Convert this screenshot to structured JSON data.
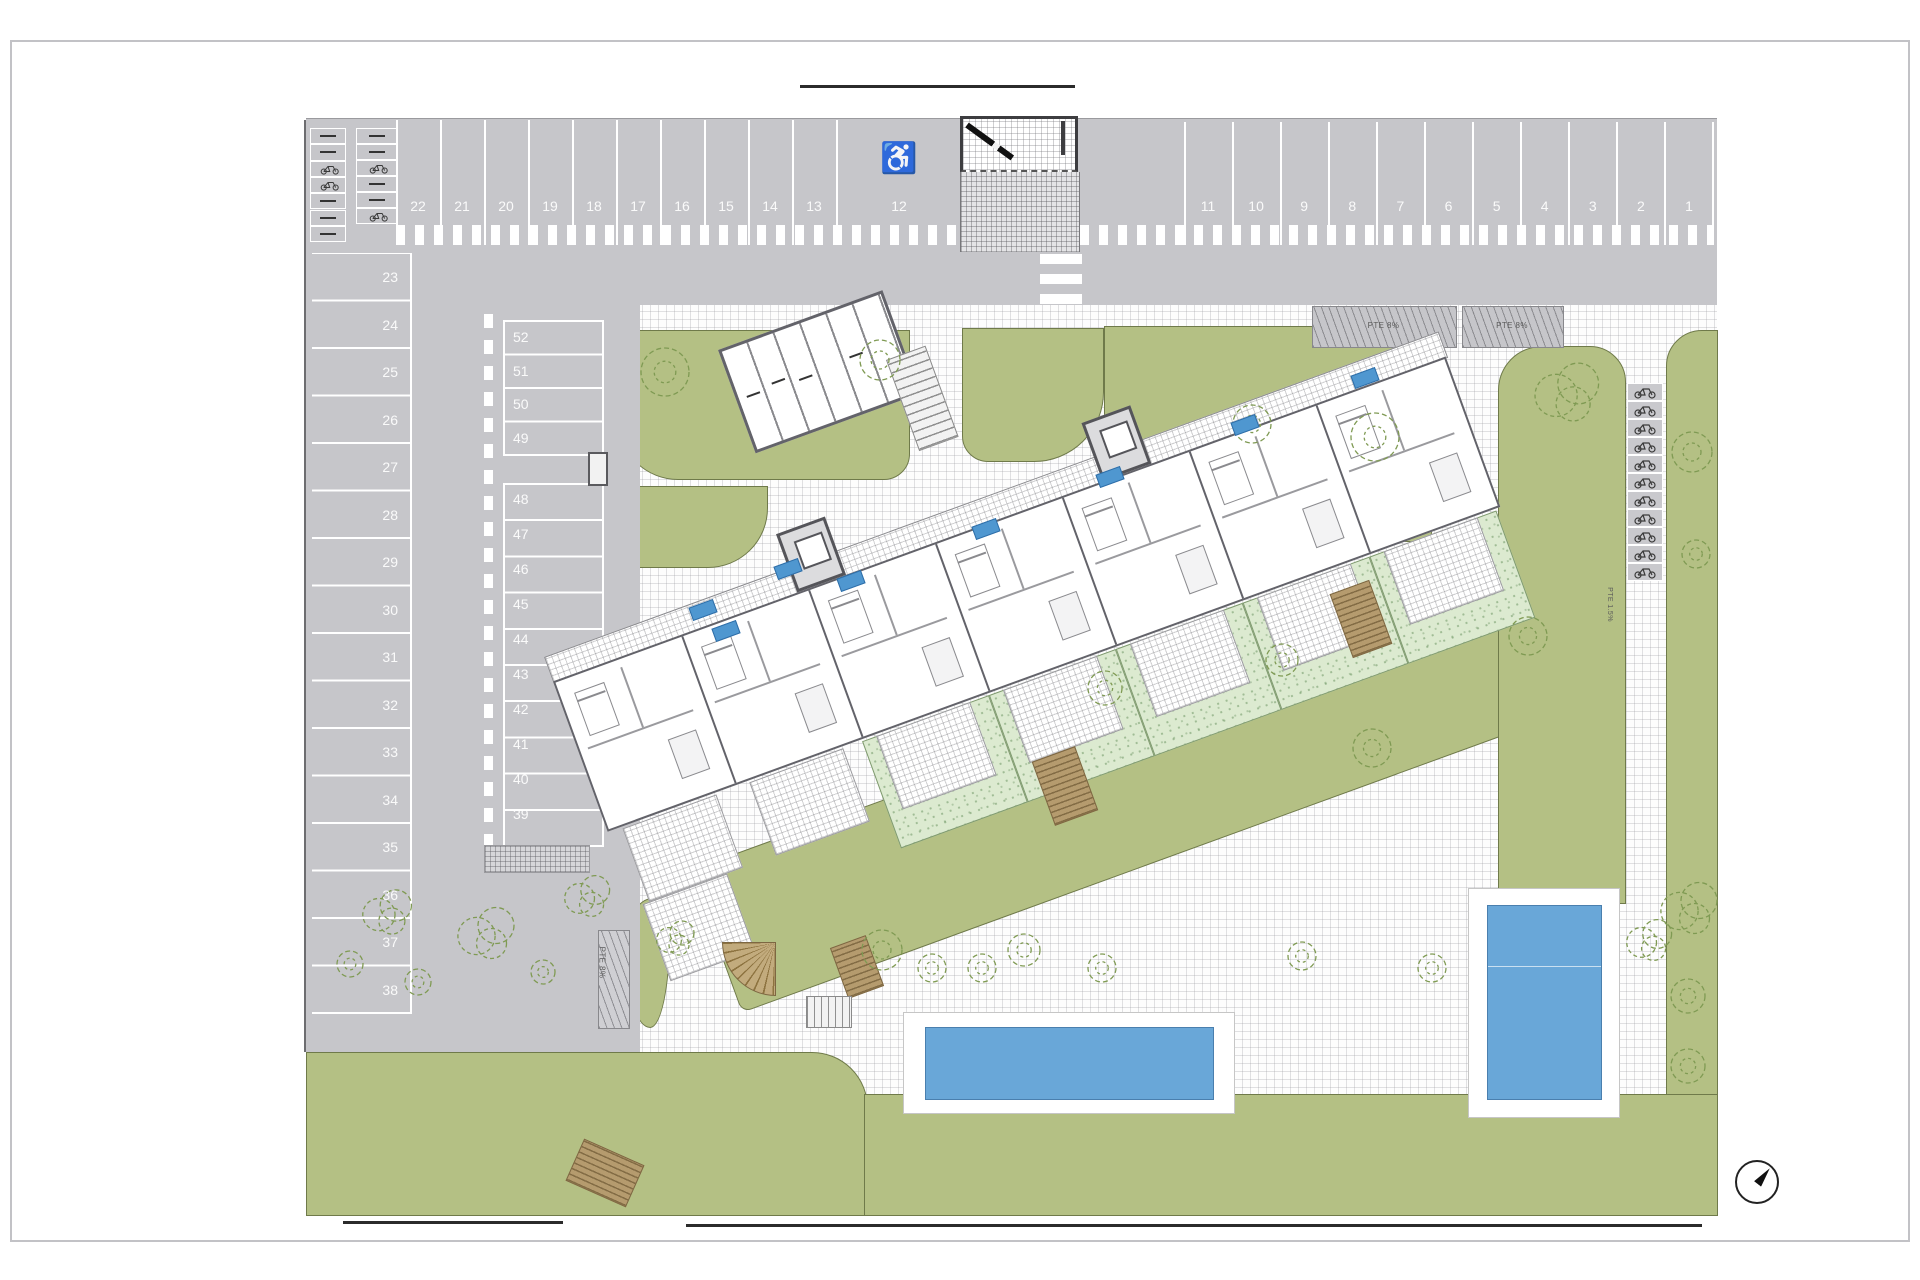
{
  "parking": {
    "top_row_left": [
      "22",
      "21",
      "20",
      "19",
      "18",
      "17",
      "16",
      "15",
      "14",
      "13"
    ],
    "handicap_space": {
      "number": "12",
      "symbol": "♿"
    },
    "top_row_right": [
      "11",
      "10",
      "9",
      "8",
      "7",
      "6",
      "5",
      "4",
      "3",
      "2",
      "1"
    ],
    "left_column": [
      "23",
      "24",
      "25",
      "26",
      "27",
      "28",
      "29",
      "30",
      "31",
      "32",
      "33",
      "34",
      "35",
      "36",
      "37",
      "38"
    ],
    "mid_column_upper": [
      "52",
      "51",
      "50",
      "49"
    ],
    "mid_column_lower": [
      "48",
      "47",
      "46",
      "45",
      "44",
      "43",
      "42",
      "41",
      "40",
      "39"
    ]
  },
  "annotations": {
    "ramp_right_1": "PTE 8%",
    "ramp_right_2": "PTE 8%",
    "ramp_left": "PTE 8%",
    "path_slope": "PTE 1.5%"
  },
  "building": {
    "apartment_plate_count": 8,
    "units": 7,
    "garden_plots": 5,
    "terraces": 8,
    "elevator_cores": 2
  },
  "bike_parking": {
    "stall_count": 11
  },
  "storage_stalls": {
    "group1_marks": [
      "dash",
      "dash",
      "bike",
      "bike",
      "dash",
      "dash",
      "dash"
    ],
    "group2_marks": [
      "dash",
      "dash",
      "bike",
      "dash",
      "dash",
      "bike"
    ]
  },
  "pools": {
    "count": 2
  },
  "compass": {
    "direction": "NE"
  },
  "colors": {
    "lawn": "#b4c084",
    "private_garden": "#dcead0",
    "pool_water": "#69a7d8",
    "parking_asphalt": "#c6c6ca",
    "wood": "#b59b6e",
    "apartment_plate": "#4f97d0"
  },
  "trees": [
    {
      "x": 665,
      "y": 372,
      "r": 24,
      "type": "ring"
    },
    {
      "x": 880,
      "y": 360,
      "r": 20,
      "type": "ring"
    },
    {
      "x": 1252,
      "y": 424,
      "r": 19,
      "type": "ring"
    },
    {
      "x": 1375,
      "y": 437,
      "r": 24,
      "type": "ring"
    },
    {
      "x": 1568,
      "y": 392,
      "r": 34,
      "type": "bush"
    },
    {
      "x": 1692,
      "y": 452,
      "r": 20,
      "type": "ring"
    },
    {
      "x": 1696,
      "y": 554,
      "r": 14,
      "type": "ring"
    },
    {
      "x": 1528,
      "y": 636,
      "r": 19,
      "type": "ring"
    },
    {
      "x": 1282,
      "y": 660,
      "r": 16,
      "type": "ring"
    },
    {
      "x": 1372,
      "y": 748,
      "r": 19,
      "type": "ring"
    },
    {
      "x": 1105,
      "y": 688,
      "r": 17,
      "type": "ring"
    },
    {
      "x": 1690,
      "y": 908,
      "r": 30,
      "type": "bush"
    },
    {
      "x": 1688,
      "y": 996,
      "r": 17,
      "type": "ring"
    },
    {
      "x": 1688,
      "y": 1066,
      "r": 17,
      "type": "ring"
    },
    {
      "x": 882,
      "y": 950,
      "r": 20,
      "type": "ring"
    },
    {
      "x": 932,
      "y": 968,
      "r": 14,
      "type": "ring"
    },
    {
      "x": 982,
      "y": 968,
      "r": 14,
      "type": "ring"
    },
    {
      "x": 1024,
      "y": 950,
      "r": 16,
      "type": "ring"
    },
    {
      "x": 1102,
      "y": 968,
      "r": 14,
      "type": "ring"
    },
    {
      "x": 1302,
      "y": 956,
      "r": 14,
      "type": "ring"
    },
    {
      "x": 1432,
      "y": 968,
      "r": 14,
      "type": "ring"
    },
    {
      "x": 1650,
      "y": 940,
      "r": 24,
      "type": "bush"
    },
    {
      "x": 388,
      "y": 912,
      "r": 26,
      "type": "bush"
    },
    {
      "x": 487,
      "y": 933,
      "r": 30,
      "type": "bush"
    },
    {
      "x": 588,
      "y": 896,
      "r": 24,
      "type": "bush"
    },
    {
      "x": 676,
      "y": 938,
      "r": 20,
      "type": "bush"
    },
    {
      "x": 418,
      "y": 982,
      "r": 13,
      "type": "ring"
    },
    {
      "x": 350,
      "y": 964,
      "r": 13,
      "type": "ring"
    },
    {
      "x": 543,
      "y": 972,
      "r": 12,
      "type": "ring"
    }
  ]
}
